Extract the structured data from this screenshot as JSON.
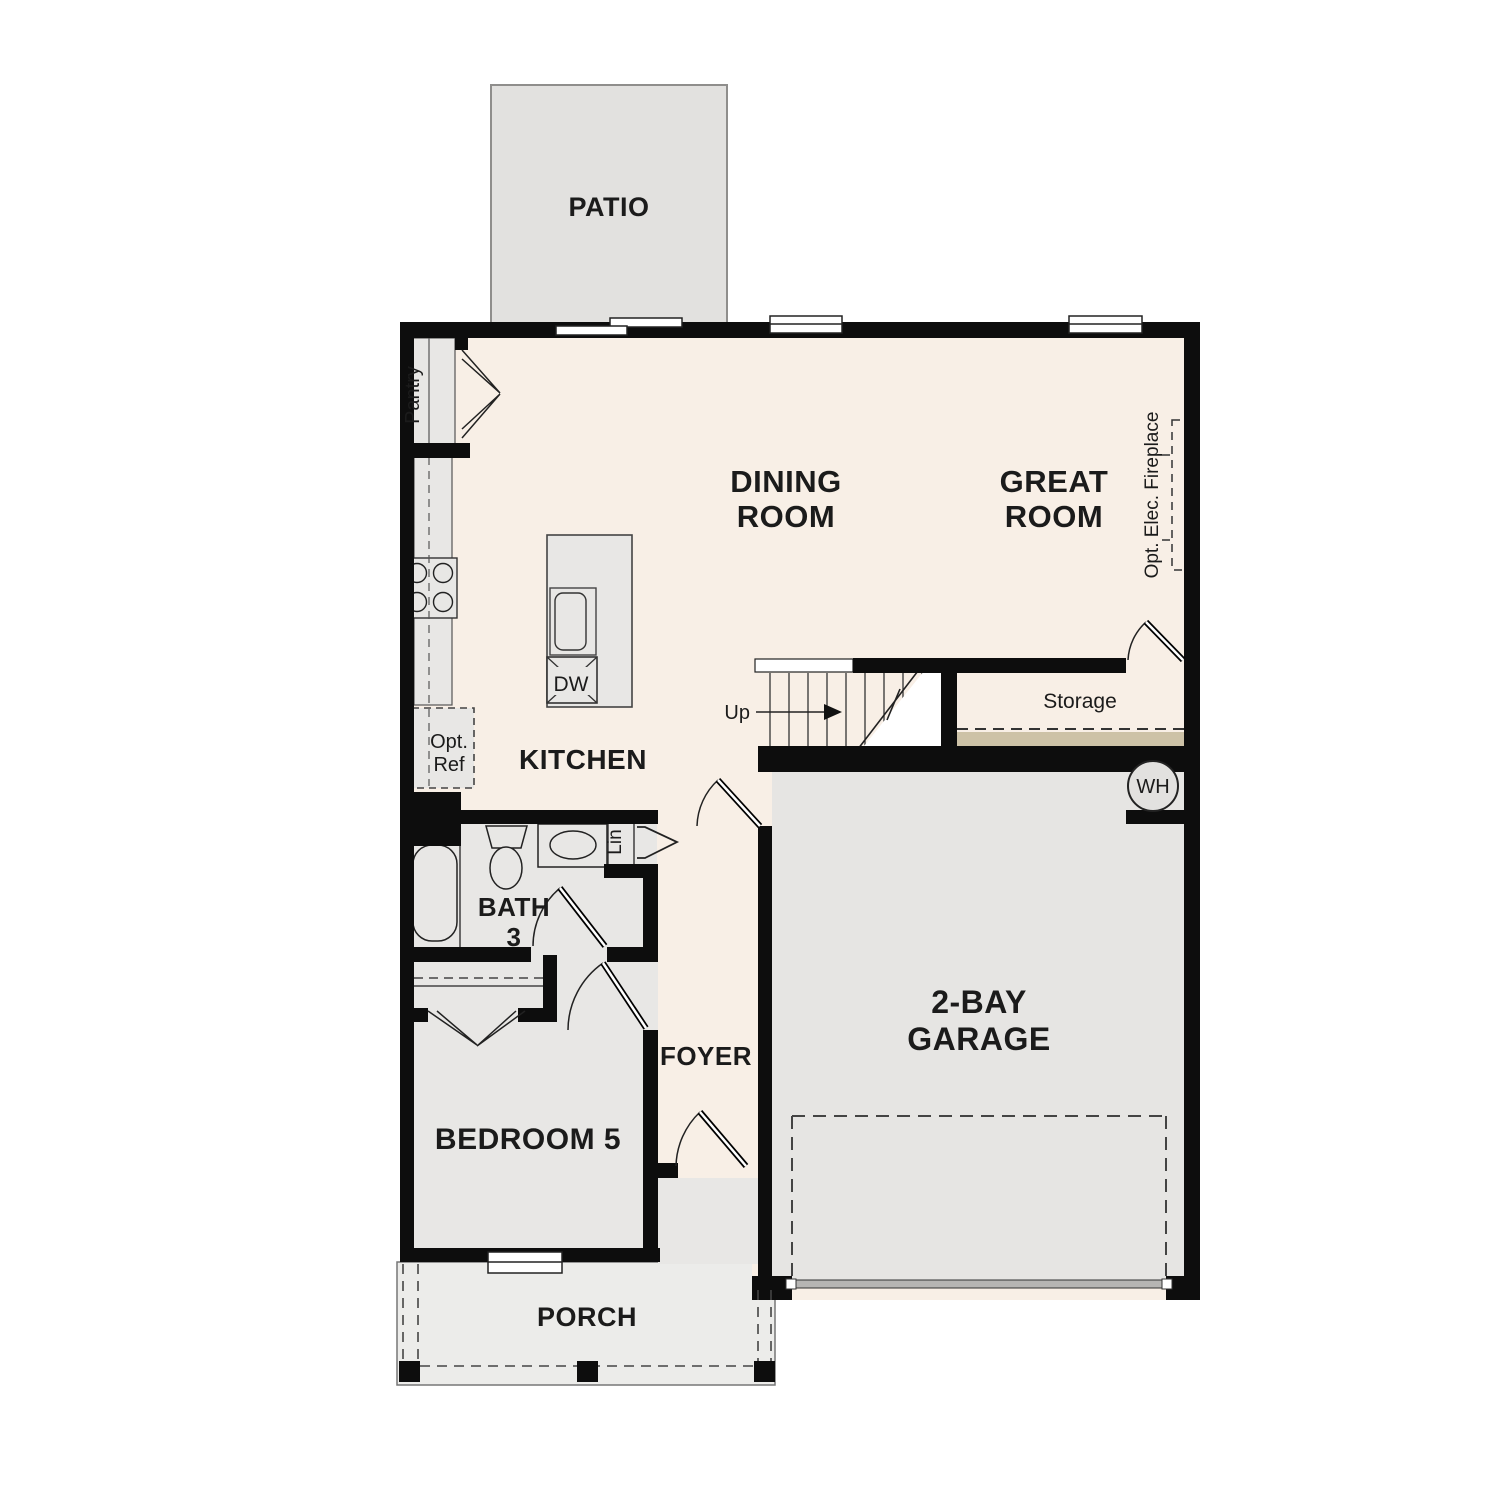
{
  "plan": {
    "type": "first-floor residential floor plan",
    "colors": {
      "interior_cream": "#f8efe6",
      "room_gray": "#e8e7e5",
      "patio_gray": "#e2e1df",
      "porch_gray": "#ececea",
      "storage_tan": "#cdc2a7",
      "wall_black": "#0d0d0d"
    },
    "rooms": {
      "patio": "PATIO",
      "dining": {
        "l1": "DINING",
        "l2": "ROOM"
      },
      "great": {
        "l1": "GREAT",
        "l2": "ROOM"
      },
      "kitchen": "KITCHEN",
      "bath": {
        "l1": "BATH",
        "l2": "3"
      },
      "foyer": "FOYER",
      "bedroom": "BEDROOM 5",
      "garage": {
        "l1": "2-BAY",
        "l2": "GARAGE"
      },
      "porch": "PORCH"
    },
    "annotations": {
      "pantry": "Pantry",
      "opt_ref": {
        "l1": "Opt.",
        "l2": "Ref"
      },
      "dw": "DW",
      "up": "Up",
      "storage": "Storage",
      "opt_fireplace": "Opt. Elec. Fireplace",
      "wh": "WH",
      "lin": "Lin"
    }
  }
}
